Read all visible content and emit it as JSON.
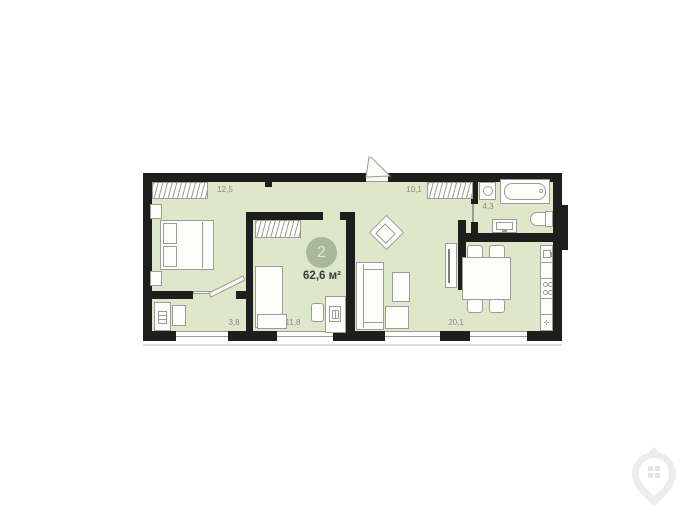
{
  "badge": {
    "number": "2",
    "area": "62,6 м²"
  },
  "rooms": [
    {
      "key": "bedroom",
      "area": "12,5"
    },
    {
      "key": "entry-hall",
      "area": "10,1"
    },
    {
      "key": "bathroom",
      "area": "4,3"
    },
    {
      "key": "hallway",
      "area": "3,8"
    },
    {
      "key": "room-2",
      "area": "11,8"
    },
    {
      "key": "living-kitchen",
      "area": "20,1"
    }
  ],
  "kitchen_symbol": "✛",
  "furniture_icons": [
    "wardrobe",
    "double-bed",
    "nightstand",
    "single-bed",
    "desk",
    "desk-chair",
    "computer",
    "armchair",
    "sofa",
    "coffee-table",
    "ottoman",
    "tv-unit",
    "dining-table",
    "dining-chair",
    "kitchen-sink",
    "stove",
    "washing-machine",
    "bathtub",
    "toilet",
    "wash-basin",
    "hall-cabinet",
    "hall-bench"
  ],
  "colors": {
    "floor": "#dfe7cb",
    "wall": "#1e1e1c",
    "badge": "#a8b898",
    "badge_text": "#e2e9d2",
    "label": "#8b8b86",
    "line": "#9d9d98",
    "text_dark": "#3a3a36",
    "window_line": "#9d9d98",
    "shadow": "#dcdcd8",
    "watermark": "#ededed"
  }
}
